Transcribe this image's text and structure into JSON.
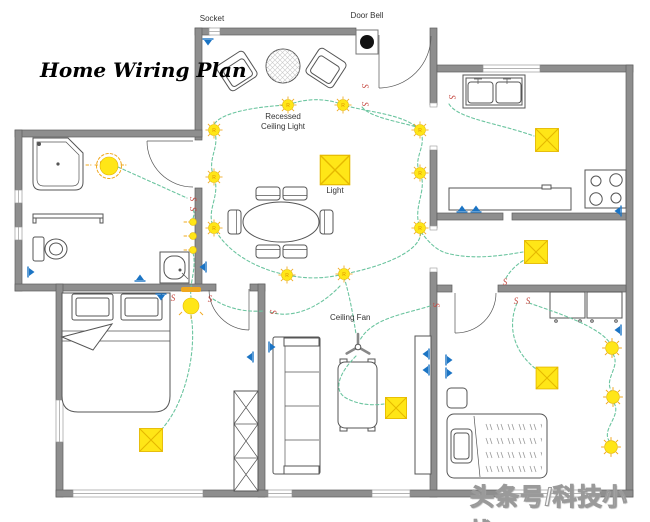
{
  "title": "Home Wiring Plan",
  "labels": {
    "socket": "Socket",
    "door_bell": "Door Bell",
    "recessed_line1": "Recessed",
    "recessed_line2": "Ceiling Light",
    "light": "Light",
    "ceiling_fan": "Ceiling Fan"
  },
  "symbols": {
    "switch": "S",
    "recessed_light": "R"
  },
  "watermark": "头条号/科技小栈",
  "colors": {
    "wall": "#8e8e8e",
    "wall-edge": "#5f5f5f",
    "wire": "#6cc5a0",
    "light-fill": "#ffe617",
    "light-accent": "#e5b800",
    "halo": "#f0a81e",
    "switch": "#c4473f",
    "socket": "#1b74c4",
    "doorbell": "#111111",
    "line": "#555555",
    "label": "#333333",
    "title": "#000000"
  }
}
